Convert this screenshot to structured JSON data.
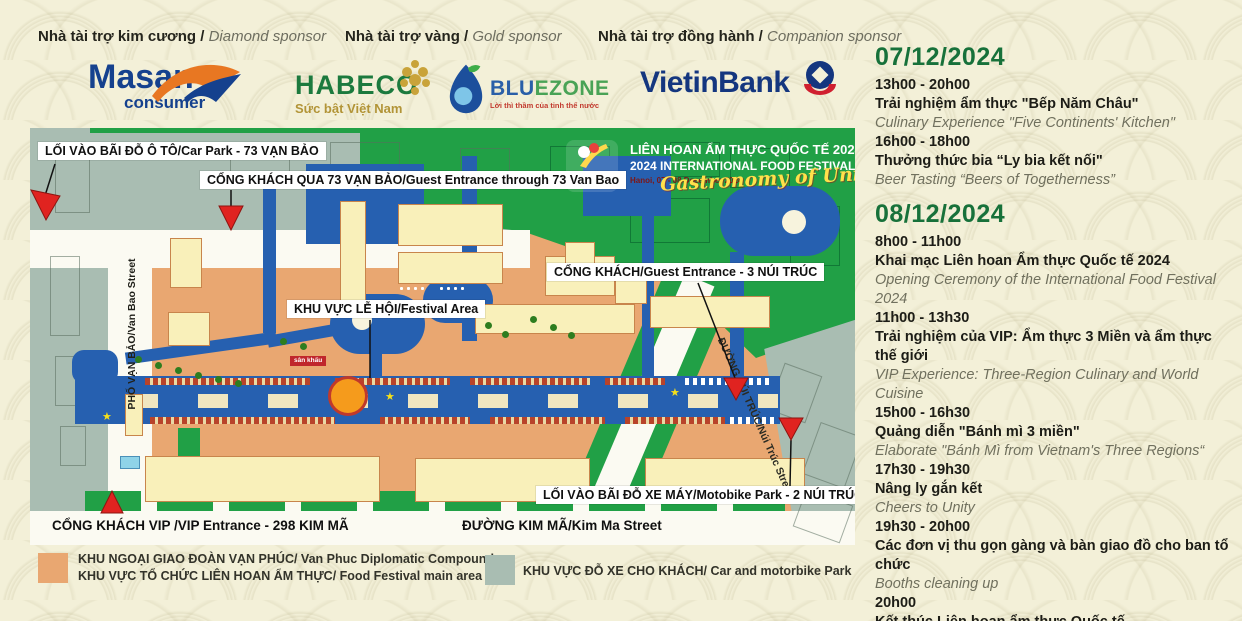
{
  "sponsors": {
    "diamond": {
      "label_vi": "Nhà tài trợ kim cương",
      "label_en": "Diamond sponsor",
      "masan": {
        "line1": "Masan",
        "line2": "consumer"
      }
    },
    "gold": {
      "label_vi": "Nhà tài trợ vàng",
      "label_en": "Gold sponsor",
      "habeco": {
        "name": "HABECO",
        "tagline": "Sức bật Việt Nam"
      },
      "bluezone": {
        "name_blue": "BLU",
        "name_green": "EZONE",
        "tagline": "Lời thì thầm của tinh thể nước"
      }
    },
    "companion": {
      "label_vi": "Nhà tài trợ đồng hành",
      "label_en": "Companion sponsor",
      "vietinbank": {
        "name": "VietinBank"
      }
    }
  },
  "banner": {
    "line1": "LIÊN HOAN ẨM THỰC QUỐC TẾ 2024",
    "line2": "2024 INTERNATIONAL FOOD FESTIVAL",
    "line3": "Hanoi, 07 - 08 December 2024",
    "script": "Gastronomy of Unity"
  },
  "map": {
    "labels": [
      "LỐI VÀO BÃI ĐỖ Ô TÔ/Car Park - 73 VẠN BẢO",
      "CỔNG KHÁCH QUA 73 VẠN BẢO/Guest Entrance through 73 Van Bao",
      "CỔNG KHÁCH/Guest Entrance - 3 NÚI TRÚC",
      "KHU VỰC LỄ HỘI/Festival Area",
      "LỐI VÀO BÃI ĐỖ XE MÁY/Motobike Park - 2 NÚI TRÚC",
      "CỔNG KHÁCH VIP /VIP Entrance - 298 KIM MÃ",
      "ĐƯỜNG KIM MÃ/Kim Ma Street"
    ],
    "streets": {
      "van_bao": "PHỐ VẠN BẢO/Van Bao Street",
      "nui_truc": "ĐƯỜNG NÚI TRÚC/Núi Trúc Street"
    },
    "stage_label": "sân khấu",
    "colors": {
      "festival_area": "#e9a771",
      "parking": "#a9bdb2",
      "park_green": "#21a046",
      "route_blue": "#2660b0"
    }
  },
  "legend": {
    "festival": {
      "line1": "KHU NGOẠI GIAO ĐOÀN VẠN PHÚC/ Van Phuc Diplomatic Compound",
      "line2": "KHU VỰC TỔ CHỨC LIÊN HOAN ẨM THỰC/ Food Festival main area"
    },
    "parking": {
      "line1": "KHU VỰC ĐỖ XE CHO KHÁCH/ Car and motorbike Park"
    }
  },
  "schedule": {
    "days": [
      {
        "date": "07/12/2024",
        "events": [
          {
            "time": "13h00 - 20h00",
            "vi": "Trải nghiệm ẩm thực \"Bếp Năm Châu\"",
            "en": "Culinary Experience \"Five Continents' Kitchen\""
          },
          {
            "time": "16h00 - 18h00",
            "vi": "Thưởng thức bia “Ly bia kết nối\"",
            "en": "Beer Tasting “Beers of Togetherness”"
          }
        ]
      },
      {
        "date": "08/12/2024",
        "events": [
          {
            "time": "8h00 - 11h00",
            "vi": "Khai mạc Liên hoan Ẩm thực Quốc tế 2024",
            "en": "Opening Ceremony of the International Food Festival 2024"
          },
          {
            "time": "11h00 - 13h30",
            "vi": "Trải nghiệm của VIP: Ẩm thực 3 Miền và ẩm thực thế giới",
            "en": "VIP Experience: Three-Region Culinary and World Cuisine"
          },
          {
            "time": "15h00 - 16h30",
            "vi": "Quảng diễn \"Bánh mì 3 miền\"",
            "en": "Elaborate \"Bánh Mì from Vietnam's Three Regions“"
          },
          {
            "time": "17h30 - 19h30",
            "vi": "Nâng ly gắn kết",
            "en": "Cheers to Unity"
          },
          {
            "time": "19h30 - 20h00",
            "vi": "Các đơn vị thu gọn gàng và bàn giao đồ cho ban tổ chức",
            "en": "Booths cleaning up"
          },
          {
            "time": "20h00",
            "vi": "Kết thúc Liên hoan ẩm thực Quốc tế",
            "en": "End of the International Food Festival"
          }
        ]
      }
    ]
  }
}
